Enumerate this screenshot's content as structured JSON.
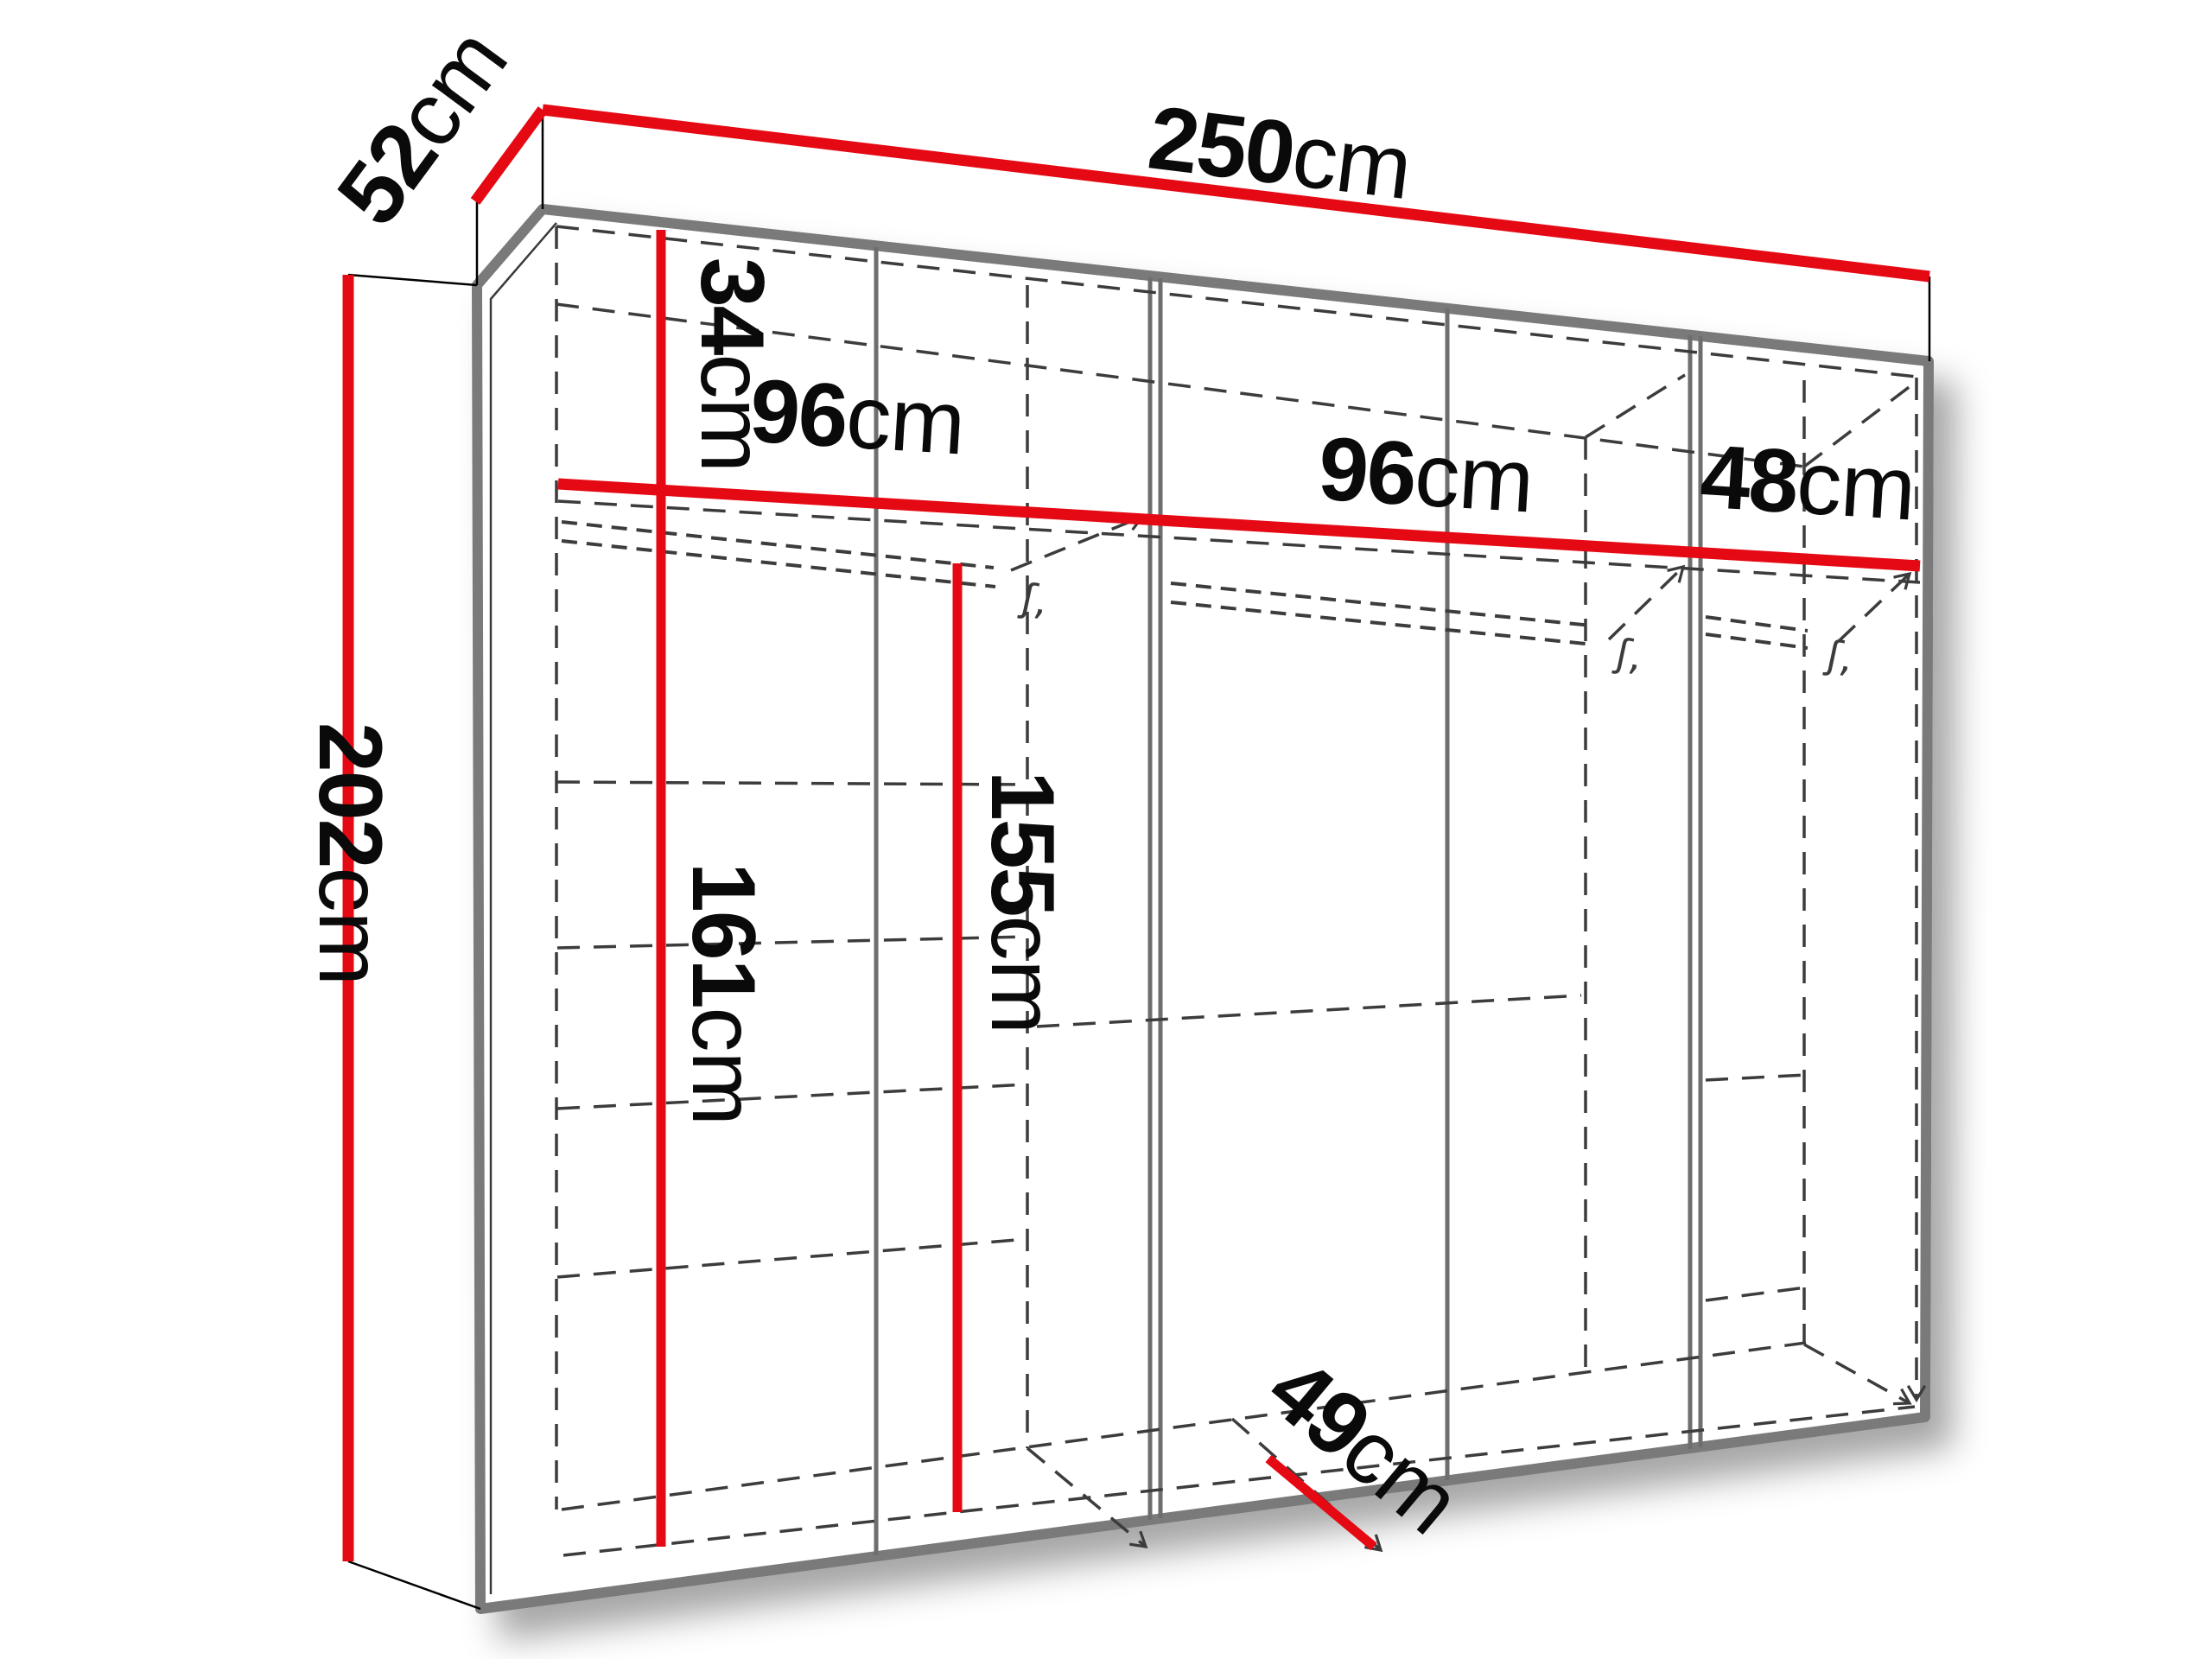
{
  "figure": {
    "kind": "furniture-dimension-diagram",
    "subject": "wardrobe interior with measurement lines"
  },
  "colors": {
    "dimension_red": "#e50914",
    "carcass_gray": "#7a7a7a",
    "divider_gray": "#6e6e6e",
    "dashed_gray": "#3c3c3c",
    "label_black": "#0a0a0a",
    "background": "#ffffff"
  },
  "dimensions": {
    "width_total": {
      "value": "250",
      "unit": "cm"
    },
    "depth_top": {
      "value": "52",
      "unit": "cm"
    },
    "height_total": {
      "value": "202",
      "unit": "cm"
    },
    "top_section_height": {
      "value": "34",
      "unit": "cm"
    },
    "section1_width": {
      "value": "96",
      "unit": "cm"
    },
    "section2_width": {
      "value": "96",
      "unit": "cm"
    },
    "section3_width": {
      "value": "48",
      "unit": "cm"
    },
    "left_lower_height": {
      "value": "161",
      "unit": "cm"
    },
    "rail_lower_height": {
      "value": "155",
      "unit": "cm"
    },
    "interior_depth": {
      "value": "49",
      "unit": "cm"
    }
  },
  "marks": {
    "rail_bracket": "ʃ,"
  }
}
